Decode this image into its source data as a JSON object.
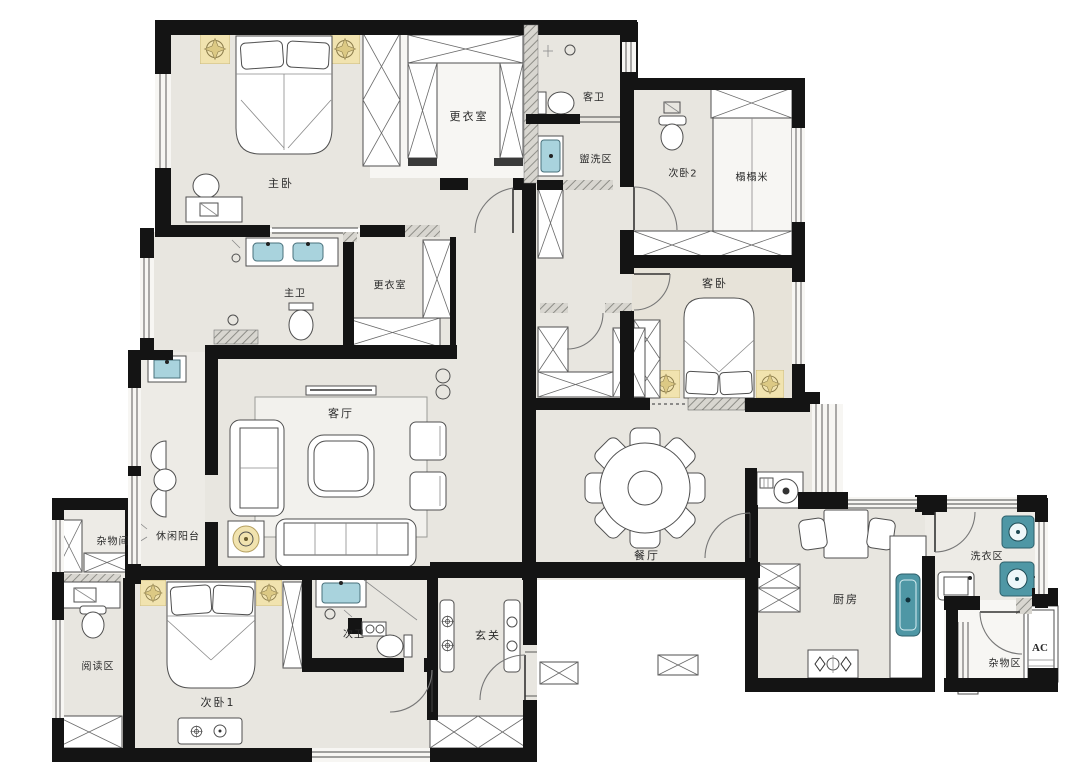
{
  "meta": {
    "type": "floor-plan",
    "description": "Residential apartment floor plan with furniture layout, Chinese room labels"
  },
  "colors": {
    "paper": "#ffffff",
    "floor": "#e8e6e0",
    "floor_warm": "#e7e3d9",
    "wall": "#141414",
    "fixture_blue": "#a9d3dd",
    "fixture_teal": "#4f97a5",
    "lamp_tan": "#f1e3af"
  },
  "rooms": [
    {
      "id": "master-bedroom",
      "label": "主卧"
    },
    {
      "id": "dressing-room-north",
      "label": "更衣室"
    },
    {
      "id": "guest-bathroom",
      "label": "客卫"
    },
    {
      "id": "wash-area",
      "label": "盥洗区"
    },
    {
      "id": "bedroom-2",
      "label": "次卧2"
    },
    {
      "id": "tatami",
      "label": "榻榻米"
    },
    {
      "id": "master-bathroom",
      "label": "主卫"
    },
    {
      "id": "dressing-room-middle",
      "label": "更衣室"
    },
    {
      "id": "guest-bedroom",
      "label": "客卧"
    },
    {
      "id": "living-room",
      "label": "客厅"
    },
    {
      "id": "leisure-balcony",
      "label": "休闲阳台"
    },
    {
      "id": "storage-room",
      "label": "杂物间"
    },
    {
      "id": "dining-room",
      "label": "餐厅"
    },
    {
      "id": "reading-area",
      "label": "阅读区"
    },
    {
      "id": "bedroom-1",
      "label": "次卧1"
    },
    {
      "id": "bathroom-2",
      "label": "次卫"
    },
    {
      "id": "entry-hall",
      "label": "玄关"
    },
    {
      "id": "kitchen",
      "label": "厨房"
    },
    {
      "id": "laundry-area",
      "label": "洗衣区"
    },
    {
      "id": "storage-area",
      "label": "杂物区"
    },
    {
      "id": "ac-closet",
      "label": "AC"
    }
  ],
  "fixtures": [
    "double-bed",
    "wardrobe",
    "walk-in-closet",
    "sofa",
    "armchair",
    "coffee-table",
    "tv-console",
    "round-dining-table",
    "dining-chair",
    "toilet",
    "washbasin",
    "shower",
    "washing-machine",
    "refrigerator",
    "gas-stove",
    "kitchen-sink",
    "ceiling-lamp",
    "tatami-platform",
    "desk",
    "reading-chair",
    "window",
    "door-swing"
  ]
}
